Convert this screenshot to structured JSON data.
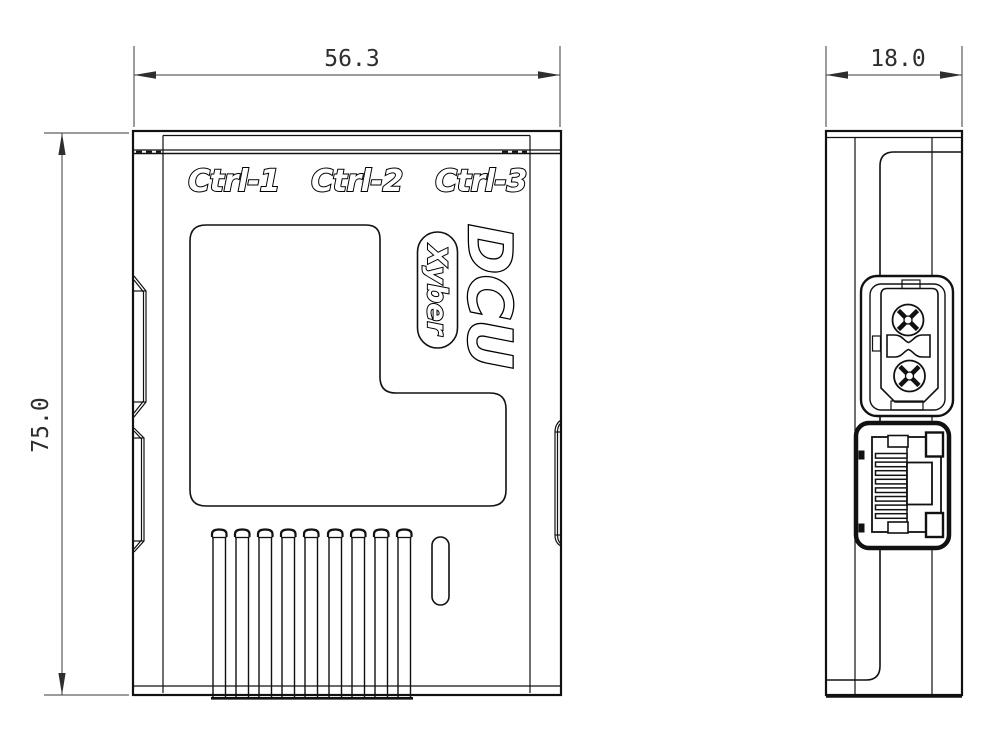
{
  "canvas": {
    "background": "#ffffff",
    "line_color": "#111111",
    "dimension_color": "#2e2e2e"
  },
  "front_view": {
    "port_labels": [
      "Ctrl-1",
      "Ctrl-2",
      "Ctrl-3"
    ],
    "logo_text": "DCU",
    "brand_text": "Xyber",
    "vent_slot_count": 9
  },
  "side_view": {
    "connector_names": [
      "xt30-power-connector",
      "rj45-ethernet-port"
    ]
  },
  "dimensions": {
    "front_width_mm": "56.3",
    "front_height_mm": "75.0",
    "side_depth_mm": "18.0"
  }
}
